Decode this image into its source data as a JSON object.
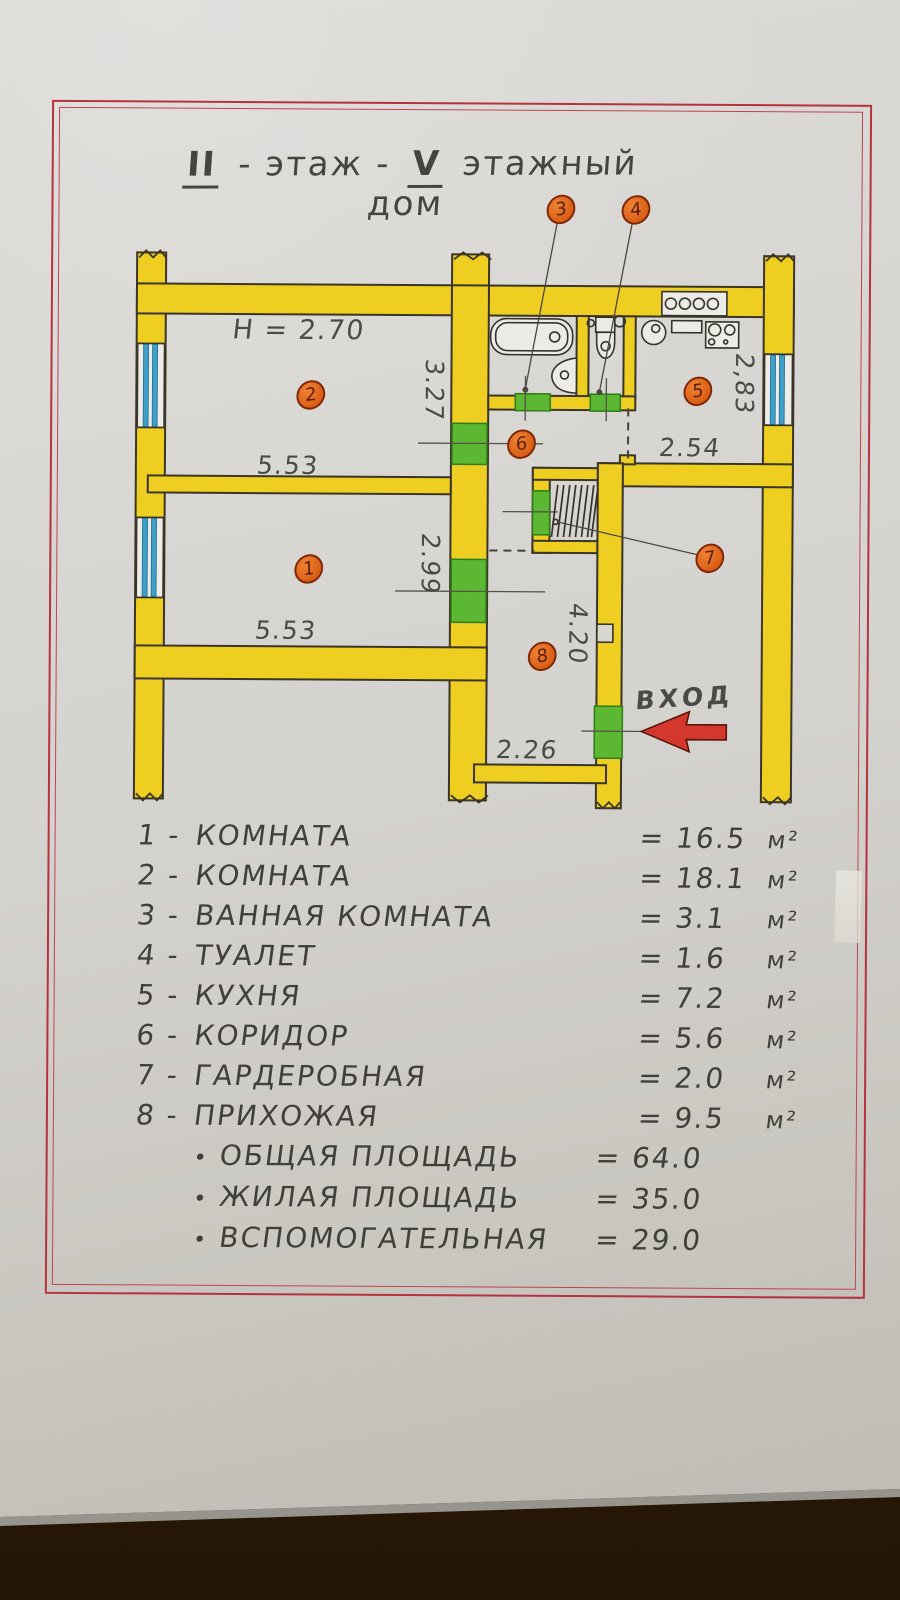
{
  "colors": {
    "wall_yellow": "#eece20",
    "door_green": "#5cb832",
    "window_blue": "#3f9fc6",
    "marker_orange": "#d95f16",
    "frame_red": "#b5323e",
    "arrow_red": "#d4372e",
    "pencil": "#45443e"
  },
  "title": {
    "roman1": "II",
    "part1": "- этаж -",
    "roman2": "V",
    "part2": "этажный дом"
  },
  "plan": {
    "ceiling_height": "Н = 2.70",
    "entrance": "ВХОД",
    "room_numbers": [
      "1",
      "2",
      "3",
      "4",
      "5",
      "6",
      "7",
      "8"
    ],
    "dims": {
      "room2_width": "5.53",
      "room2_depth": "3.27",
      "room1_width": "5.53",
      "room1_depth": "2.99",
      "kitchen_depth": "2,83",
      "kitchen_width": "2.54",
      "hall_length": "4.20",
      "hall_width": "2.26"
    }
  },
  "legend": {
    "bullet": "•",
    "items": [
      {
        "num": "1 -",
        "name": "КОМНАТА",
        "value": "= 16.5",
        "unit": "м²"
      },
      {
        "num": "2 -",
        "name": "КОМНАТА",
        "value": "= 18.1",
        "unit": "м²"
      },
      {
        "num": "3 -",
        "name": "ВАННАЯ КОМНАТА",
        "value": "= 3.1",
        "unit": "м²"
      },
      {
        "num": "4 -",
        "name": "ТУАЛЕТ",
        "value": "= 1.6",
        "unit": "м²"
      },
      {
        "num": "5 -",
        "name": "КУХНЯ",
        "value": "= 7.2",
        "unit": "м²"
      },
      {
        "num": "6 -",
        "name": "КОРИДОР",
        "value": "= 5.6",
        "unit": "м²"
      },
      {
        "num": "7 -",
        "name": "ГАРДЕРОБНАЯ",
        "value": "= 2.0",
        "unit": "м²"
      },
      {
        "num": "8 -",
        "name": "ПРИХОЖАЯ",
        "value": "= 9.5",
        "unit": "м²"
      }
    ],
    "totals": [
      {
        "name": "ОБЩАЯ ПЛОЩАДЬ",
        "value": "= 64.0"
      },
      {
        "name": "ЖИЛАЯ ПЛОЩАДЬ",
        "value": "= 35.0"
      },
      {
        "name": "ВСПОМОГАТЕЛЬНАЯ",
        "value": "= 29.0"
      }
    ]
  }
}
